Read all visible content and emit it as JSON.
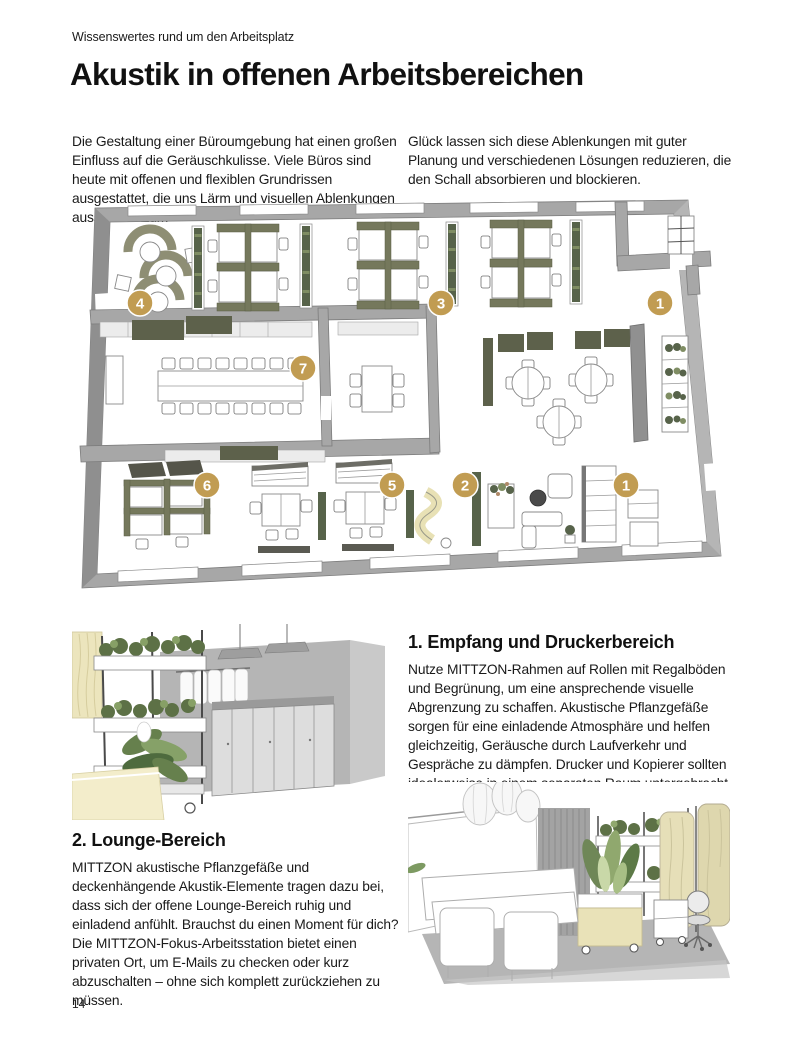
{
  "page": {
    "eyebrow": "Wissenswertes rund um den Arbeitsplatz",
    "title": "Akustik in offenen Arbeitsbereichen",
    "page_number": "14"
  },
  "intro": {
    "col_left": "Die Gestaltung einer Büroumgebung hat einen großen Einfluss auf die Geräuschkulisse. Viele Büros sind heute mit offenen und flexiblen Grundrissen ausgestattet, die uns Lärm und visuellen Ablenkungen aussetzen. Zum",
    "col_right": "Glück lassen sich diese Ablenkungen mit guter Planung und verschiedenen Lösungen reduzieren, die den Schall absorbieren und blockieren."
  },
  "floorplan": {
    "description": "Isometrischer Grundriss eines offenen Büros mit nummerierten Bereichen",
    "badge_color": "#c19c52",
    "badges": [
      {
        "label": "4",
        "x": 70,
        "y": 107
      },
      {
        "label": "3",
        "x": 371,
        "y": 107
      },
      {
        "label": "1",
        "x": 590,
        "y": 107
      },
      {
        "label": "7",
        "x": 233,
        "y": 172
      },
      {
        "label": "6",
        "x": 137,
        "y": 289
      },
      {
        "label": "5",
        "x": 322,
        "y": 289
      },
      {
        "label": "2",
        "x": 395,
        "y": 289
      },
      {
        "label": "1",
        "x": 556,
        "y": 289
      }
    ]
  },
  "sections": [
    {
      "heading": "1. Empfang und Druckerbereich",
      "body": "Nutze MITTZON-Rahmen auf Rollen mit Regalböden und Begrünung, um eine ansprechende visuelle Abgrenzung zu schaffen. Akustische Pflanzgefäße sorgen für eine einladende Atmosphäre und helfen gleichzeitig, Geräusche durch Laufverkehr und Gespräche zu dämpfen. Drucker und Kopierer sollten idealerweise in einem separaten Raum untergebracht werden."
    },
    {
      "heading": "2. Lounge-Bereich",
      "body": "MITTZON akustische Pflanzgefäße und deckenhängende Akustik-Elemente tragen dazu bei, dass sich der offene Lounge-Bereich ruhig und einladend anfühlt. Brauchst du einen Moment für dich? Die MITTZON-Fokus-Arbeitsstation bietet einen privaten Ort, um E-Mails zu checken oder kurz abzuschalten – ohne sich komplett zurückziehen zu müssen."
    }
  ],
  "colors": {
    "accent_gold": "#c19c52",
    "plant_green": "#57634a",
    "wall_gray": "#a7a7a7",
    "cream": "#ece5bd"
  }
}
